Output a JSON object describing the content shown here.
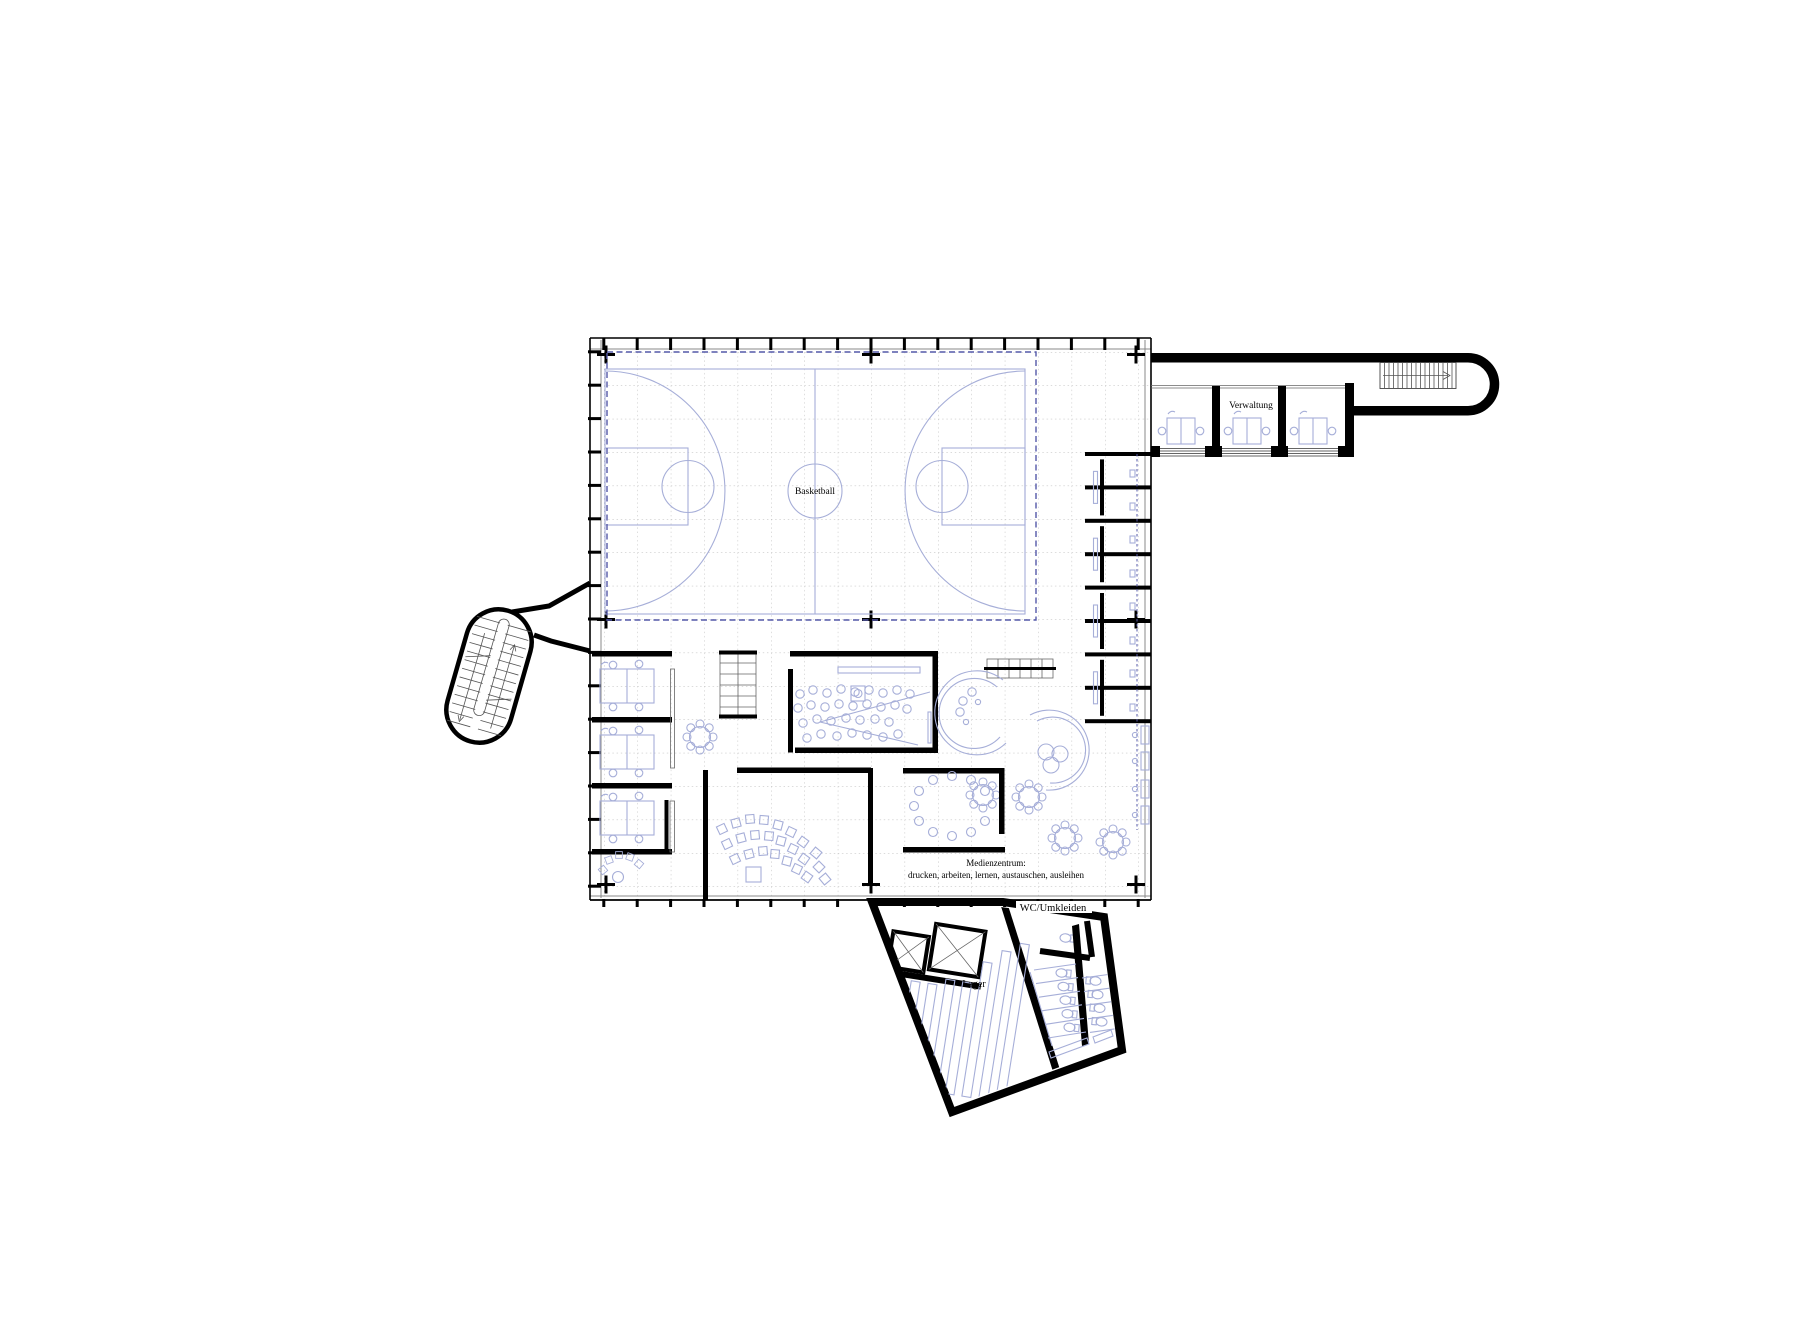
{
  "plan": {
    "labels": {
      "basketball": "Basketball",
      "verwaltung": "Verwaltung",
      "medienzentrum_line1": "Medienzentrum:",
      "medienzentrum_line2": "drucken, arbeiten, lernen, austauschen, ausleihen",
      "wc_umkleiden": "WC/Umkleiden",
      "lager": "Lager"
    },
    "colors": {
      "wall": "#000000",
      "accent": "#a6aed8",
      "navy": "#5458a8",
      "grid": "#b4b4b4",
      "background": "#ffffff"
    }
  }
}
